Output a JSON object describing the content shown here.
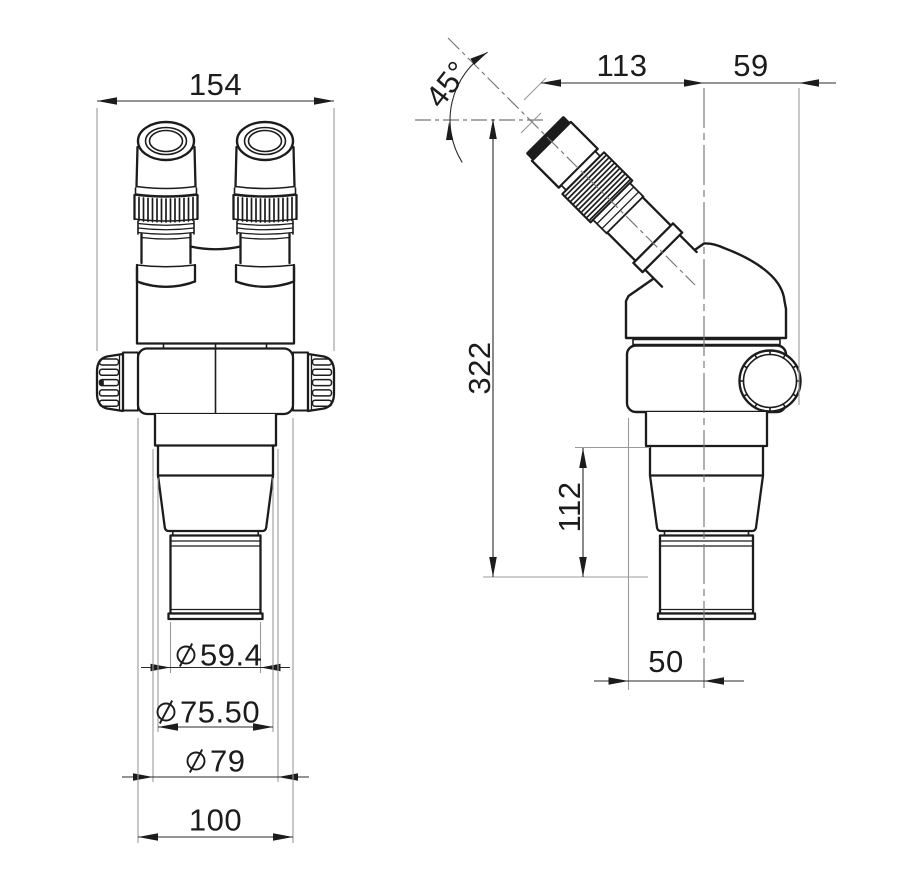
{
  "colors": {
    "line": "#1c1c1c",
    "dimension": "#2a2a2a",
    "extension": "#9b9b9b",
    "centerline": "#777777",
    "background": "#ffffff"
  },
  "front_view": {
    "width": "154",
    "diameters": {
      "d1": {
        "symbol": "⌀",
        "value": "59.4"
      },
      "d2": {
        "symbol": "⌀",
        "value": "75.50"
      },
      "d3": {
        "symbol": "⌀",
        "value": "79"
      }
    },
    "base_width": "100"
  },
  "side_view": {
    "eyepiece_angle": "45°",
    "eyepiece_reach": "113",
    "axis_to_knob": "59",
    "overall_height": "322",
    "lower_height": "112",
    "body_to_axis": "50"
  }
}
